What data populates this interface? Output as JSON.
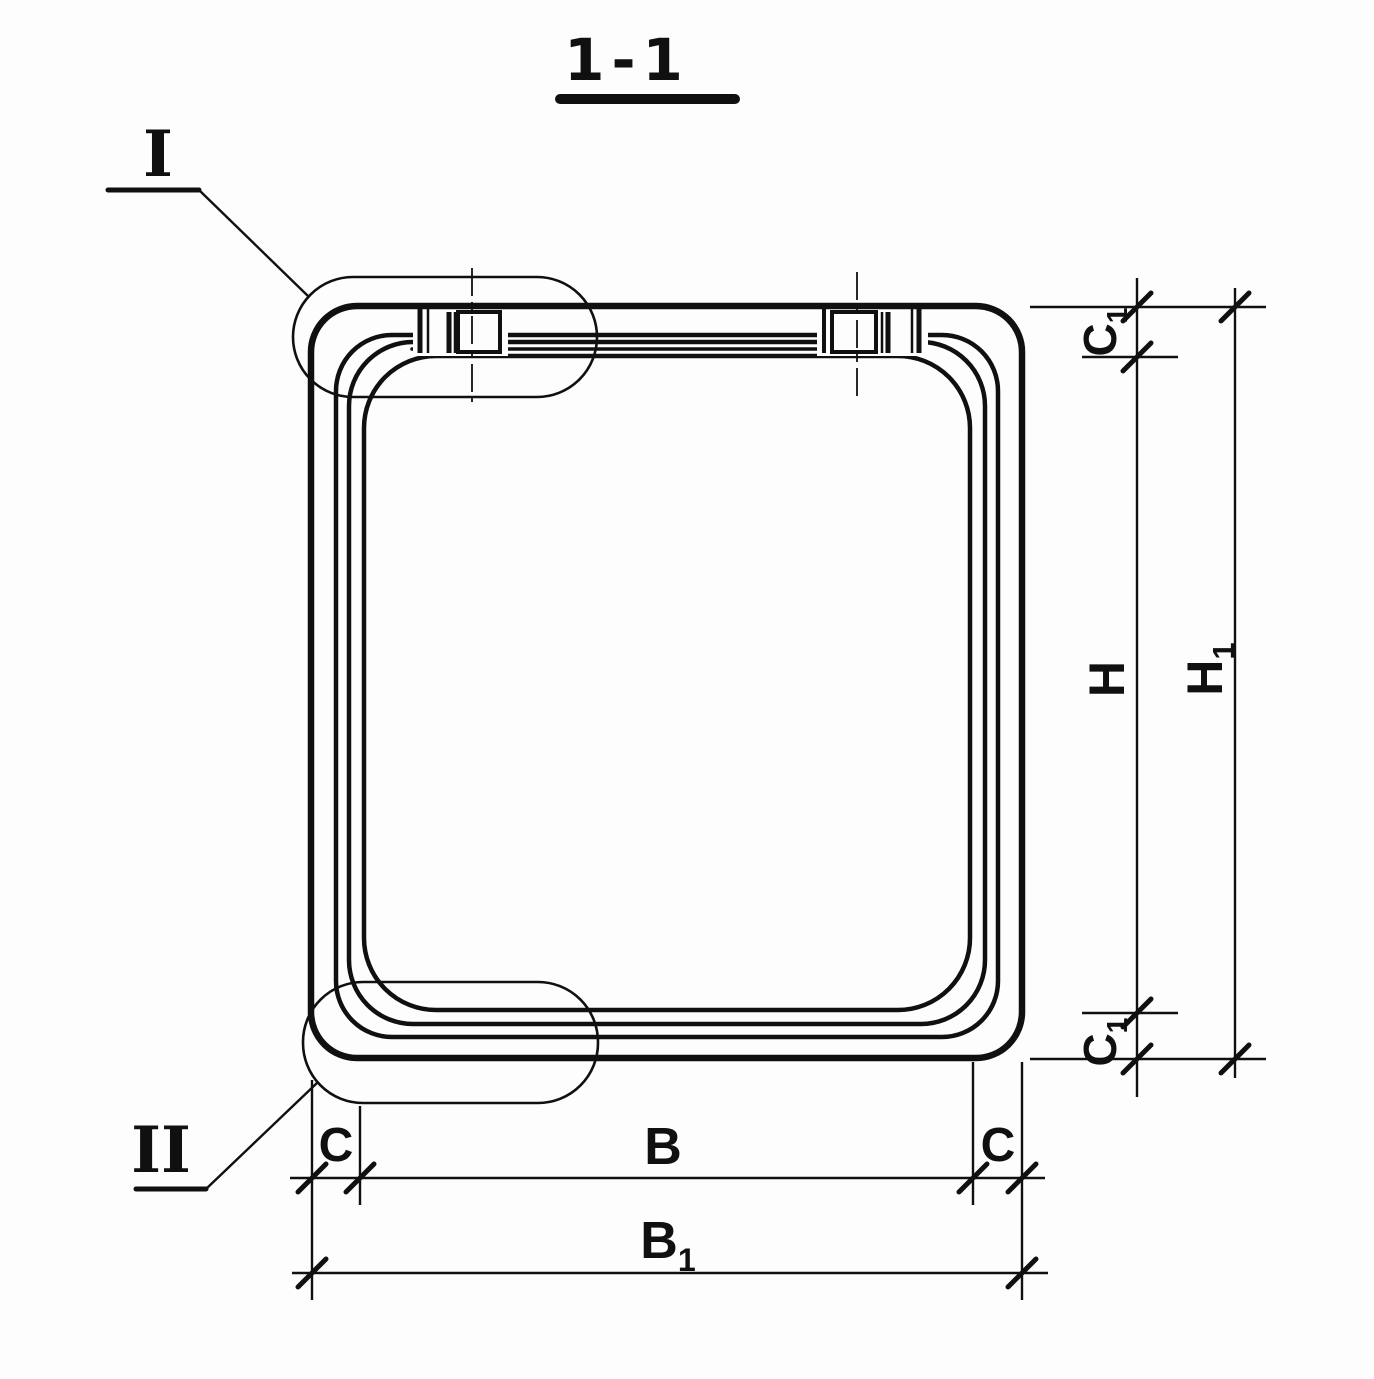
{
  "meta": {
    "ink_color": "#101010",
    "background_color": "#fdfdfd",
    "drawing_type": "section-view"
  },
  "title": {
    "text": "1-1"
  },
  "details": {
    "top": {
      "label": "I"
    },
    "bottom": {
      "label": "II"
    }
  },
  "dims": {
    "c1_top": {
      "base": "C",
      "sub": "1"
    },
    "h": {
      "base": "H",
      "sub": ""
    },
    "h1": {
      "base": "H",
      "sub": "1"
    },
    "c1_bottom": {
      "base": "C",
      "sub": "1"
    },
    "c_left": {
      "base": "C",
      "sub": ""
    },
    "b": {
      "base": "B",
      "sub": ""
    },
    "c_right": {
      "base": "C",
      "sub": ""
    },
    "b1": {
      "base": "B",
      "sub": "1"
    }
  }
}
